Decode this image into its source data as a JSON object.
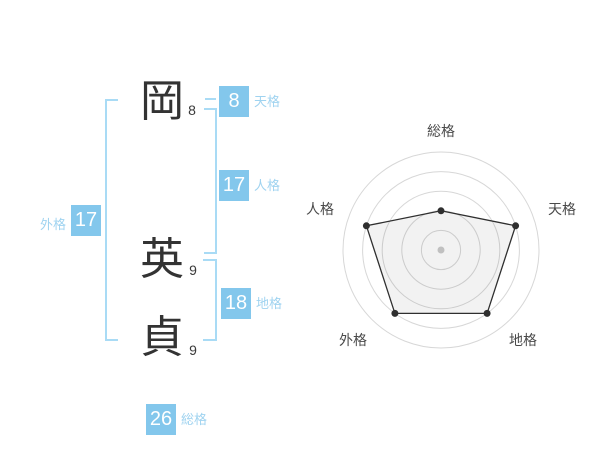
{
  "name_analysis": {
    "characters": [
      {
        "char": "岡",
        "strokes": "8"
      },
      {
        "char": "英",
        "strokes": "9"
      },
      {
        "char": "貞",
        "strokes": "9"
      }
    ],
    "gauges": {
      "tenkaku": {
        "value": "8",
        "label": "天格"
      },
      "jinkaku": {
        "value": "17",
        "label": "人格"
      },
      "chikaku": {
        "value": "18",
        "label": "地格"
      },
      "gaikaku": {
        "value": "17",
        "label": "外格"
      },
      "soukaku": {
        "value": "26",
        "label": "総格"
      }
    },
    "colors": {
      "badge_blue": "#83c7ec",
      "label_blue": "#9fd3f0",
      "bracket_blue": "#a9dbf5",
      "text_dark": "#333333"
    }
  },
  "chart_data": {
    "type": "radar",
    "axes": [
      "総格",
      "天格",
      "地格",
      "外格",
      "人格"
    ],
    "series": [
      {
        "name": "運勢スコア",
        "values": [
          2,
          4,
          4,
          4,
          4
        ]
      }
    ],
    "max": 5,
    "rings": 5,
    "grid_shape": "concentric-circles",
    "legend": false,
    "colors": {
      "grid": "#d7d7d7",
      "polygon_stroke": "#2f2f2f",
      "polygon_fill": "rgba(0,0,0,0.05)",
      "point": "#2f2f2f",
      "center_dot": "#c0c0c0",
      "axis_label": "#4a4a4a"
    }
  }
}
